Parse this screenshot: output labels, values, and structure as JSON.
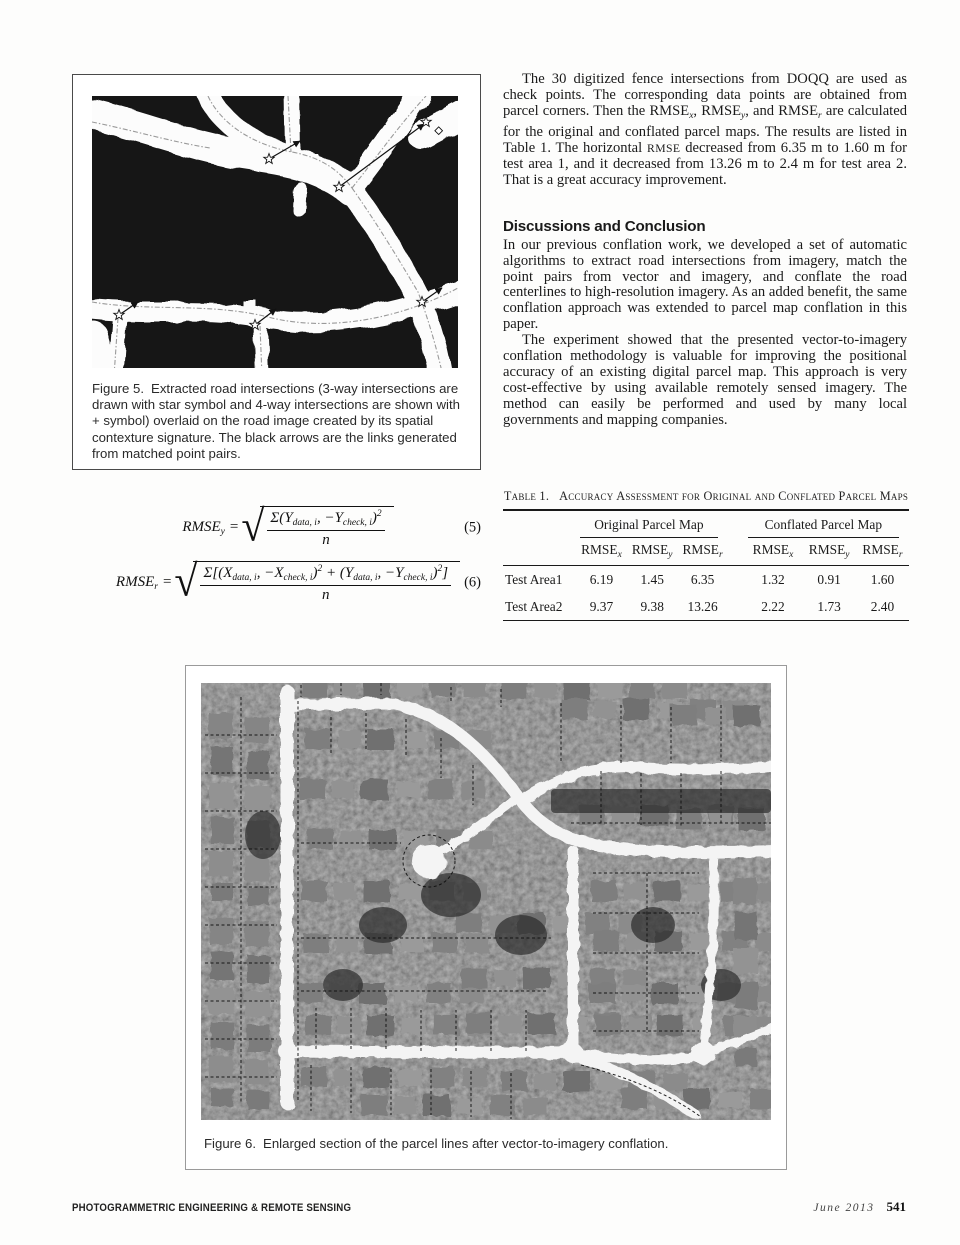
{
  "body_text": {
    "para1_parts": [
      {
        "t": "The 30 digitized fence intersections from DOQQ are used as check points. The corresponding data points are obtained from parcel corners. Then the RMSE"
      },
      {
        "t": "x",
        "sub": true
      },
      {
        "t": ", RMSE"
      },
      {
        "t": "y",
        "sub": true
      },
      {
        "t": ", and RMSE"
      },
      {
        "t": "r",
        "sub": true
      },
      {
        "t": " are calculated for the original and conflated parcel maps. The results are listed in Table 1. The horizontal "
      },
      {
        "t": "RMSE",
        "sc": true
      },
      {
        "t": " decreased from 6.35 m to 1.60 m for test area 1, and it decreased from 13.26 m to 2.4 m for test area 2. That is a great accuracy improvement."
      }
    ],
    "section_heading": "Discussions and Conclusion",
    "para2": "In our previous conflation work, we developed a set of automatic algorithms to extract road intersections from imagery, match the point pairs from vector and imagery, and conflate the road centerlines to high-resolution imagery. As an added benefit, the same conflation approach was extended to parcel map conflation in this paper.",
    "para3": "The experiment showed that the presented vector-to-imagery conflation methodology is valuable for improving the positional accuracy of an existing digital parcel map. This approach is very cost-effective by using available remotely sensed imagery. The method can easily be performed and used by many local governments and mapping companies."
  },
  "figure5": {
    "label": "Figure 5.",
    "caption": "Extracted road intersections (3-way intersections are drawn with star symbol and 4-way intersections are shown with + symbol) overlaid on the road image created by its spatial contexture signature. The black arrows are the links generated from matched point pairs."
  },
  "figure6": {
    "label": "Figure 6.",
    "caption": "Enlarged section of the parcel lines after vector-to-imagery conflation."
  },
  "equations": [
    {
      "number": "(5)",
      "lhs": "RMSE",
      "lhs_sub": "y",
      "numerator": [
        {
          "t": "Σ("
        },
        {
          "t": "Y",
          "i": true
        },
        {
          "t": "data, i",
          "sub": true
        },
        {
          "t": ", −"
        },
        {
          "t": "Y",
          "i": true
        },
        {
          "t": "check, i",
          "sub": true
        },
        {
          "t": ")"
        },
        {
          "t": "2",
          "sup": true
        }
      ],
      "denominator": "n"
    },
    {
      "number": "(6)",
      "lhs": "RMSE",
      "lhs_sub": "r",
      "numerator": [
        {
          "t": "Σ[("
        },
        {
          "t": "X",
          "i": true
        },
        {
          "t": "data, i",
          "sub": true
        },
        {
          "t": ", −"
        },
        {
          "t": "X",
          "i": true
        },
        {
          "t": "check, i",
          "sub": true
        },
        {
          "t": ")"
        },
        {
          "t": "2",
          "sup": true
        },
        {
          "t": " + ("
        },
        {
          "t": "Y",
          "i": true
        },
        {
          "t": "data, i",
          "sub": true
        },
        {
          "t": ", −"
        },
        {
          "t": "Y",
          "i": true
        },
        {
          "t": "check, i",
          "sub": true
        },
        {
          "t": ")"
        },
        {
          "t": "2",
          "sup": true
        },
        {
          "t": "]"
        }
      ],
      "denominator": "n"
    }
  ],
  "table": {
    "label": "Table 1.",
    "title": "Accuracy Assessment for Original and Conflated Parcel Maps",
    "groups": [
      "Original Parcel Map",
      "Conflated Parcel Map"
    ],
    "column_base": "RMSE",
    "column_subs": [
      "x",
      "y",
      "r",
      "x",
      "y",
      "r"
    ],
    "rows": [
      {
        "label": "Test Area1",
        "values": [
          "6.19",
          "1.45",
          "6.35",
          "1.32",
          "0.91",
          "1.60"
        ]
      },
      {
        "label": "Test Area2",
        "values": [
          "9.37",
          "9.38",
          "13.26",
          "2.22",
          "1.73",
          "2.40"
        ]
      }
    ]
  },
  "footer": {
    "journal": "PHOTOGRAMMETRIC ENGINEERING & REMOTE SENSING",
    "issue": "June 2013",
    "page_number": "541"
  }
}
